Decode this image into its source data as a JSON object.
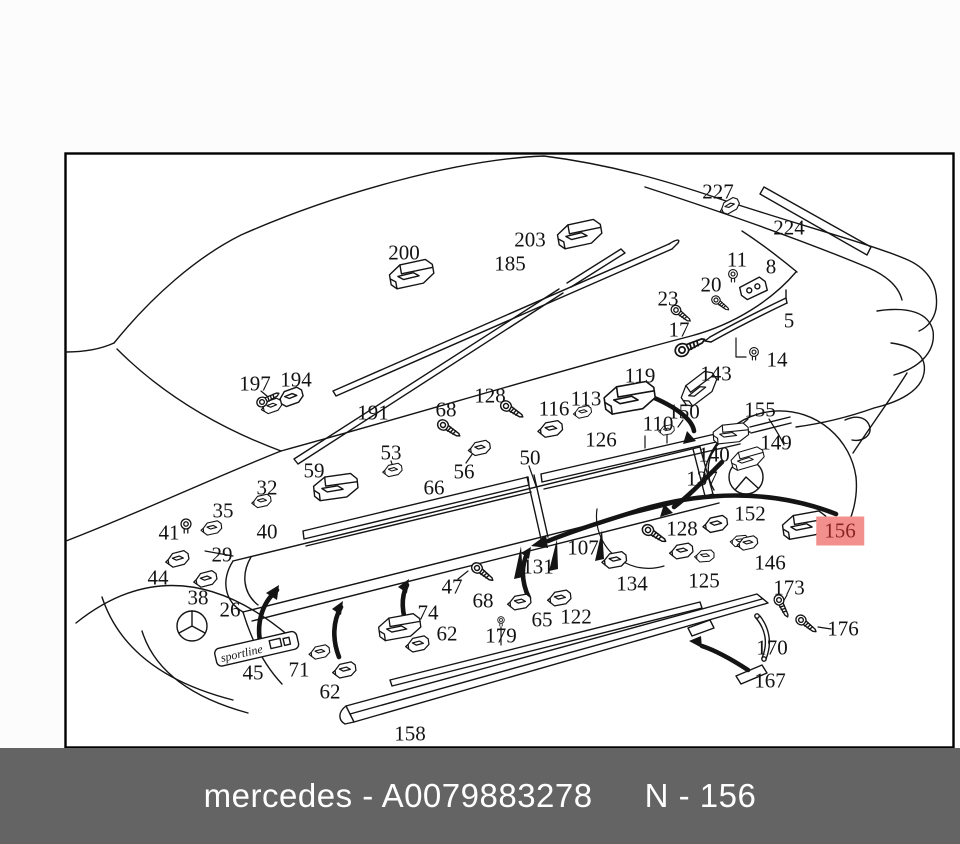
{
  "diagram": {
    "highlight": {
      "part": "156",
      "bg": "#f2908e",
      "text_color": "#8b2424"
    },
    "badge_text": "sportline",
    "labels": [
      {
        "t": "200",
        "x": 404,
        "y": 253
      },
      {
        "t": "203",
        "x": 530,
        "y": 240
      },
      {
        "t": "185",
        "x": 510,
        "y": 264
      },
      {
        "t": "227",
        "x": 718,
        "y": 192
      },
      {
        "t": "224",
        "x": 789,
        "y": 228
      },
      {
        "t": "11",
        "x": 737,
        "y": 260
      },
      {
        "t": "8",
        "x": 771,
        "y": 267
      },
      {
        "t": "20",
        "x": 711,
        "y": 285
      },
      {
        "t": "23",
        "x": 668,
        "y": 299
      },
      {
        "t": "17",
        "x": 679,
        "y": 330
      },
      {
        "t": "5",
        "x": 789,
        "y": 321
      },
      {
        "t": "14",
        "x": 777,
        "y": 360
      },
      {
        "t": "197",
        "x": 255,
        "y": 384
      },
      {
        "t": "194",
        "x": 296,
        "y": 380
      },
      {
        "t": "191",
        "x": 373,
        "y": 413
      },
      {
        "t": "68",
        "x": 446,
        "y": 410
      },
      {
        "t": "128",
        "x": 490,
        "y": 396
      },
      {
        "t": "116",
        "x": 554,
        "y": 409
      },
      {
        "t": "113",
        "x": 586,
        "y": 399
      },
      {
        "t": "119",
        "x": 640,
        "y": 376
      },
      {
        "t": "143",
        "x": 716,
        "y": 374
      },
      {
        "t": "150",
        "x": 684,
        "y": 412
      },
      {
        "t": "110",
        "x": 658,
        "y": 424
      },
      {
        "t": "155",
        "x": 760,
        "y": 410
      },
      {
        "t": "149",
        "x": 776,
        "y": 443
      },
      {
        "t": "126",
        "x": 601,
        "y": 440
      },
      {
        "t": "140",
        "x": 714,
        "y": 455
      },
      {
        "t": "137",
        "x": 702,
        "y": 479
      },
      {
        "t": "59",
        "x": 314,
        "y": 471
      },
      {
        "t": "53",
        "x": 391,
        "y": 453
      },
      {
        "t": "56",
        "x": 464,
        "y": 472
      },
      {
        "t": "50",
        "x": 530,
        "y": 458
      },
      {
        "t": "66",
        "x": 434,
        "y": 488
      },
      {
        "t": "32",
        "x": 267,
        "y": 488
      },
      {
        "t": "35",
        "x": 223,
        "y": 511
      },
      {
        "t": "41",
        "x": 169,
        "y": 533
      },
      {
        "t": "40",
        "x": 267,
        "y": 532
      },
      {
        "t": "29",
        "x": 222,
        "y": 555
      },
      {
        "t": "44",
        "x": 158,
        "y": 578
      },
      {
        "t": "38",
        "x": 198,
        "y": 598
      },
      {
        "t": "26",
        "x": 230,
        "y": 610
      },
      {
        "t": "152",
        "x": 750,
        "y": 514
      },
      {
        "t": "128",
        "x": 682,
        "y": 529
      },
      {
        "t": "156",
        "x": 840,
        "y": 531,
        "hl": true
      },
      {
        "t": "146",
        "x": 770,
        "y": 563
      },
      {
        "t": "125",
        "x": 704,
        "y": 581
      },
      {
        "t": "134",
        "x": 632,
        "y": 584
      },
      {
        "t": "107",
        "x": 583,
        "y": 548
      },
      {
        "t": "131",
        "x": 538,
        "y": 567
      },
      {
        "t": "47",
        "x": 452,
        "y": 587
      },
      {
        "t": "68",
        "x": 483,
        "y": 601
      },
      {
        "t": "74",
        "x": 428,
        "y": 613
      },
      {
        "t": "62",
        "x": 447,
        "y": 634
      },
      {
        "t": "65",
        "x": 542,
        "y": 620
      },
      {
        "t": "122",
        "x": 576,
        "y": 617
      },
      {
        "t": "179",
        "x": 501,
        "y": 636
      },
      {
        "t": "173",
        "x": 789,
        "y": 588
      },
      {
        "t": "176",
        "x": 843,
        "y": 629
      },
      {
        "t": "170",
        "x": 772,
        "y": 648
      },
      {
        "t": "167",
        "x": 770,
        "y": 681
      },
      {
        "t": "45",
        "x": 253,
        "y": 673
      },
      {
        "t": "71",
        "x": 299,
        "y": 670
      },
      {
        "t": "62",
        "x": 330,
        "y": 692
      },
      {
        "t": "158",
        "x": 410,
        "y": 734
      }
    ]
  },
  "footer": {
    "caption_left": "mercedes - A0079883278",
    "caption_right": "N - 156",
    "bg": "#646464",
    "text_color": "#ffffff"
  },
  "colors": {
    "line": "#141414",
    "paper": "#fcfcfc"
  }
}
